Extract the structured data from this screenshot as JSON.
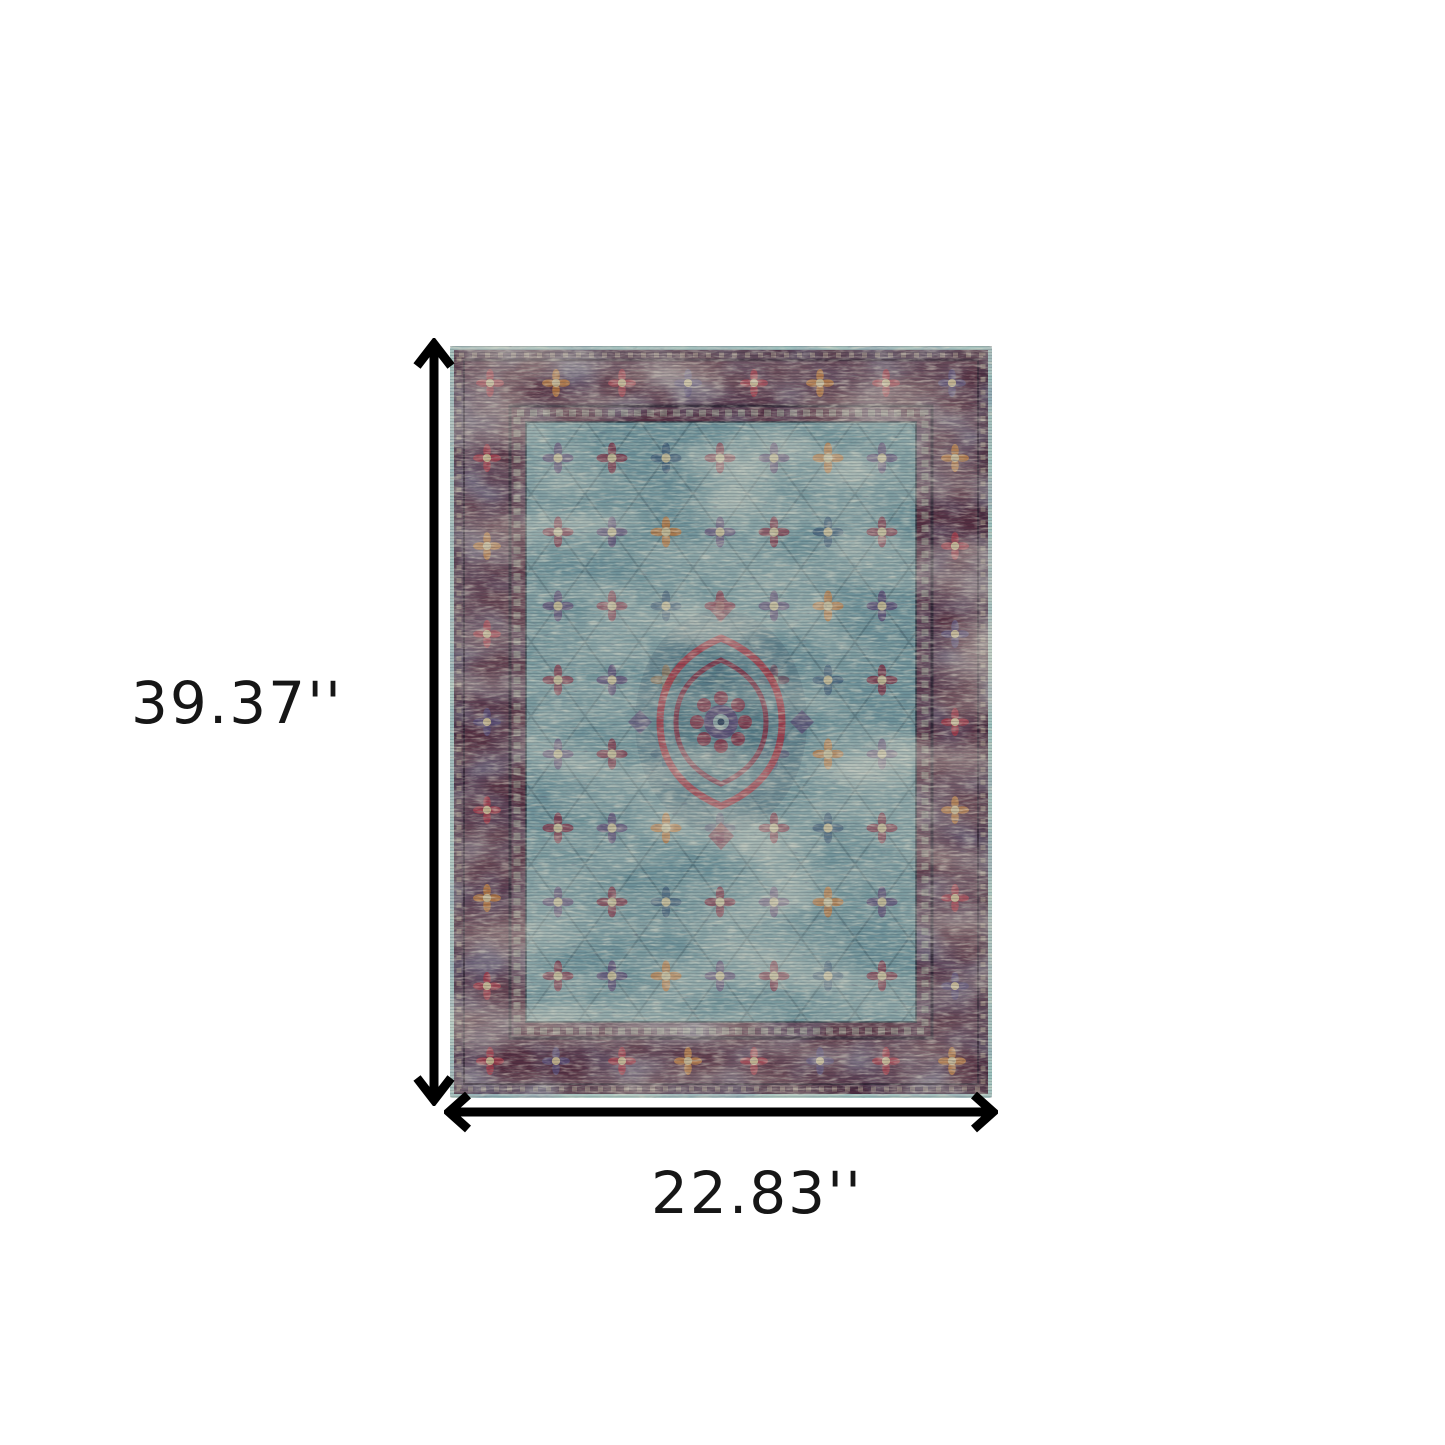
{
  "diagram": {
    "type": "product-dimensions",
    "background_color": "#ffffff",
    "arrow_color": "#000000",
    "label_color": "#161616",
    "labels": {
      "height": "39.37''",
      "width": "22.83''"
    },
    "product": {
      "name": "distressed-oriental-area-rug",
      "shape": "rectangle",
      "palette": {
        "edge_binding": "#9ec4c0",
        "outer_band": "#46253a",
        "border_ground": "#532b3e",
        "border_rose": "#a03a4a",
        "field_ground": "#6e929a",
        "faded_beige": "#c5bb9b",
        "medallion_red": "#9e3a48",
        "motif_purple": "#594a74",
        "motif_maroon": "#7c3448",
        "motif_navy": "#3f5c78",
        "motif_gold": "#b4743e"
      }
    }
  }
}
